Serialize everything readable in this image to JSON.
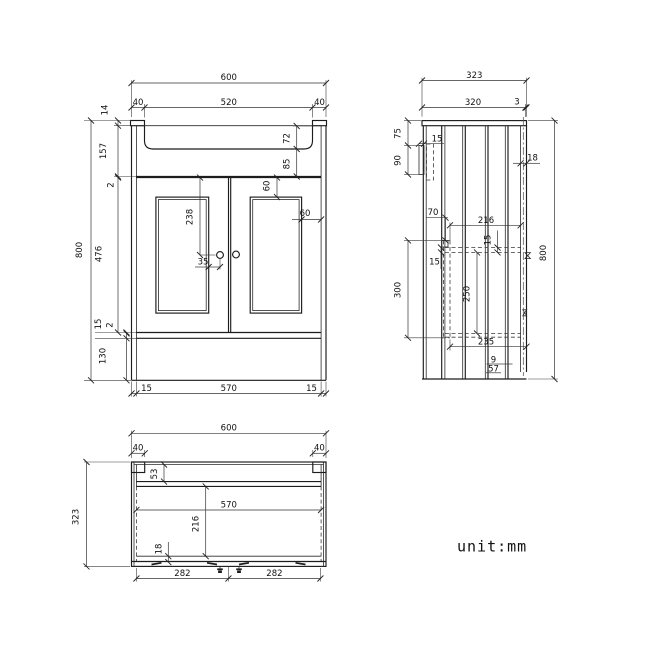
{
  "unit_note": "unit:mm",
  "front_view": {
    "overall_width": "600",
    "basin_opening": "520",
    "basin_margin_left": "40",
    "basin_margin_right": "40",
    "top_trim_height": "14",
    "basin_zone_height": "157",
    "top_gap": "2",
    "basin_depth": "72",
    "basin_to_doors": "85",
    "panel_top_inset": "60",
    "panel_side_inset": "60",
    "handle_drop": "238",
    "handle_inset": "35",
    "door_height": "476",
    "bottom_gap": "2",
    "bottom_rail": "15",
    "plinth_height": "130",
    "overall_height": "800",
    "base_side_left": "15",
    "base_width": "570",
    "base_side_right": "15"
  },
  "side_view": {
    "overall_depth": "323",
    "top_depth": "320",
    "back_lip": "3",
    "bracket_offset": "75",
    "bracket_height": "90",
    "bracket_depth": "15",
    "back_rail_thickness": "18",
    "rail_drop": "70",
    "inner_depth": "216",
    "rail_thickness_right": "15",
    "recess_height": "300",
    "rail_thickness_left": "15",
    "shelf_spacing": "250",
    "base_depth": "235",
    "back_gap": "9",
    "plinth_recess": "57",
    "overall_height": "800"
  },
  "plan_view": {
    "overall_width": "600",
    "corner_left": "40",
    "corner_right": "40",
    "front_rail_offset": "53",
    "inner_width": "570",
    "inner_depth": "216",
    "front_thickness": "18",
    "door_width_left": "282",
    "door_width_right": "282",
    "overall_depth": "323"
  }
}
